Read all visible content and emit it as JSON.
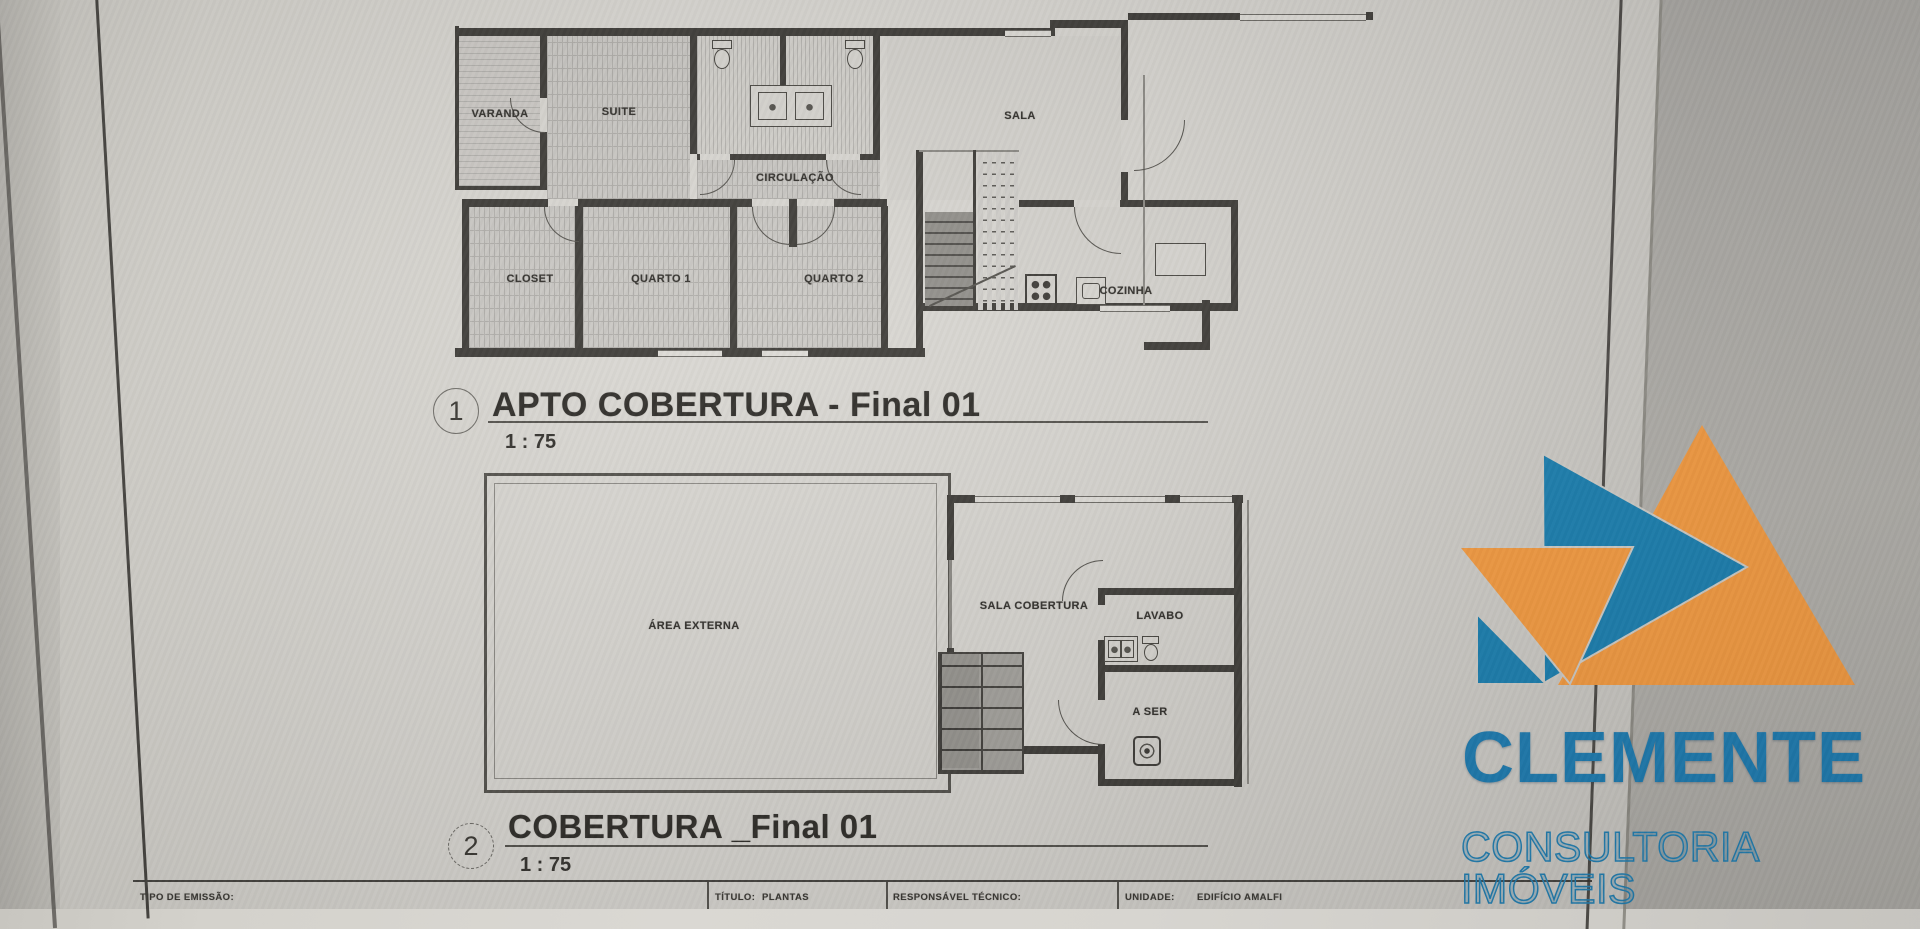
{
  "plans": {
    "plan1": {
      "number": "1",
      "title": "APTO COBERTURA - Final 01",
      "scale": "1 : 75",
      "rooms": {
        "varanda": "VARANDA",
        "suite": "SUITE",
        "sala": "SALA",
        "circulacao": "CIRCULAÇÃO",
        "closet": "CLOSET",
        "quarto1": "QUARTO 1",
        "quarto2": "QUARTO 2",
        "cozinha": "COZINHA"
      }
    },
    "plan2": {
      "number": "2",
      "title": "COBERTURA _Final 01",
      "scale": "1 : 75",
      "rooms": {
        "area_externa": "ÁREA EXTERNA",
        "sala_cobertura": "SALA COBERTURA",
        "lavabo": "LAVABO",
        "a_ser": "A SER"
      }
    }
  },
  "title_block": {
    "tipo_label": "TIPO DE EMISSÃO:",
    "titulo_label": "TÍTULO:",
    "titulo_value": "PLANTAS",
    "responsavel_label": "RESPONSÁVEL TÉCNICO:",
    "unidade_label": "UNIDADE:",
    "unidade_value": "EDIFÍCIO AMALFI"
  },
  "watermark": {
    "brand": "CLEMENTE",
    "tagline": "CONSULTORIA IMÓVEIS",
    "orange": "#f59b40",
    "blue": "#1a7fb0"
  }
}
